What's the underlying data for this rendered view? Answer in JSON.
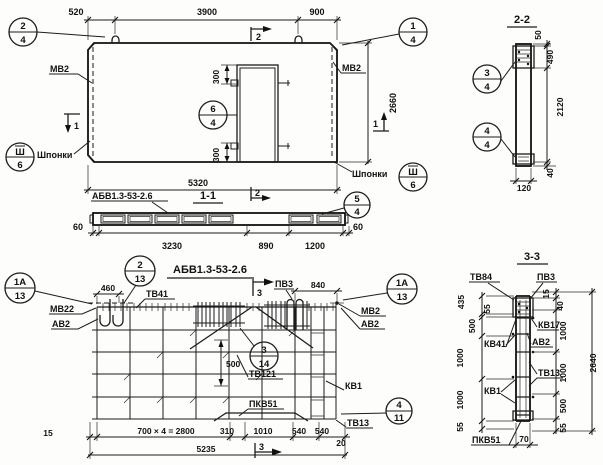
{
  "plan": {
    "dims": {
      "left": "520",
      "mid": "3900",
      "right": "900",
      "height": "2660",
      "width": "5320",
      "open_top": "300",
      "open_bot": "300"
    },
    "labels": {
      "mv2_left": "МВ2",
      "mv2_right": "МВ2",
      "shponki_left": "Шпонки",
      "shponki_right": "Шпонки"
    },
    "marks": {
      "s1_left": "1",
      "s1_right": "1",
      "s2_top": "2"
    },
    "callouts": {
      "c24": {
        "top": "2",
        "bot": "4"
      },
      "c14": {
        "top": "1",
        "bot": "4"
      },
      "csh_left": {
        "top": "Ш",
        "bot": "6"
      },
      "csh_right": {
        "top": "Ш",
        "bot": "6"
      },
      "c64": {
        "top": "6",
        "bot": "4"
      }
    }
  },
  "sec22": {
    "title": "2-2",
    "dims": {
      "d50": "50",
      "d490": "490",
      "d2120": "2120",
      "d40": "40",
      "d120": "120"
    },
    "callouts": {
      "c34": {
        "top": "3",
        "bot": "4"
      },
      "c44": {
        "top": "4",
        "bot": "4"
      }
    }
  },
  "sec11": {
    "label": "АБВ1.3-53-2.6",
    "title": "1-1",
    "mark": "2",
    "dims": {
      "d60l": "60",
      "d3230": "3230",
      "d890": "890",
      "d1200": "1200",
      "d60r": "60"
    },
    "callouts": {
      "c54": {
        "top": "5",
        "bot": "4"
      }
    }
  },
  "plan2": {
    "title": "АБВ1.3-53-2.6",
    "labels": {
      "tv41": "ТВ41",
      "mv22": "МВ22",
      "av2_left": "АВ2",
      "pv3": "ПВ3",
      "mv2": "МВ2",
      "av2_right": "АВ2",
      "tv121": "ТВ121",
      "kv1": "КВ1",
      "tv13": "ТВ13",
      "pkv51": "ПКВ51"
    },
    "dims": {
      "d460": "460",
      "d840": "840",
      "d500": "500",
      "d15": "15",
      "d2800": "700 × 4 = 2800",
      "d310": "310",
      "d1010": "1010",
      "d540a": "540",
      "d540b": "540",
      "d20": "20",
      "d5235": "5235"
    },
    "marks": {
      "s3_top": "3",
      "s3_bot": "3"
    },
    "callouts": {
      "c213": {
        "top": "2",
        "bot": "13"
      },
      "c1a13_left": {
        "top": "1А",
        "bot": "13"
      },
      "c1a13_right": {
        "top": "1А",
        "bot": "13"
      },
      "c314": {
        "top": "3",
        "bot": "14"
      },
      "c411": {
        "top": "4",
        "bot": "11"
      }
    }
  },
  "sec33": {
    "title": "3-3",
    "labels": {
      "tv84": "ТВ84",
      "pv3": "ПВ3",
      "kv17": "КВ17",
      "av2": "АВ2",
      "kv41": "КВ41",
      "tv13": "ТВ13",
      "kv1": "КВ1",
      "pkv51": "ПКВ51"
    },
    "dims_left": {
      "d435": "435",
      "d55t": "55",
      "d500": "500",
      "d1000a": "1000",
      "d1000b": "1000",
      "d55b": "55"
    },
    "dims_right": {
      "d15": "15",
      "d40": "40",
      "d1000a": "1000",
      "d1000b": "1000",
      "d500": "500",
      "d55": "55",
      "total": "2640",
      "d70": "70"
    }
  }
}
